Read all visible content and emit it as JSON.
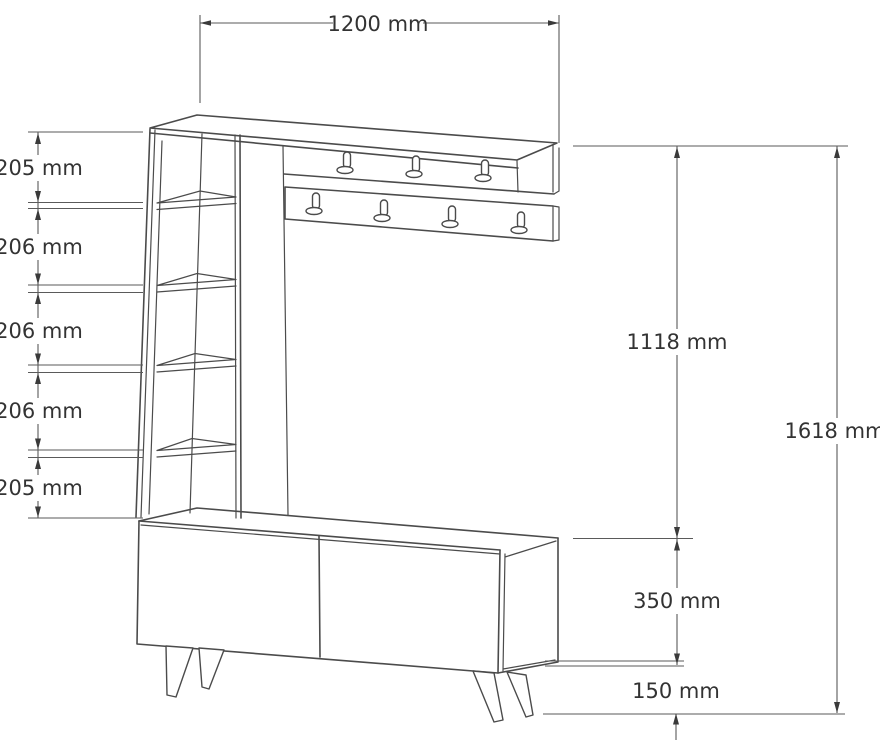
{
  "drawing": {
    "unit": "mm",
    "background_color": "#ffffff",
    "furniture_line_color": "#4b4b4b",
    "dimension_line_color": "#5a5a5a",
    "label_text_color": "#333333"
  },
  "dimensions": {
    "top_width": {
      "label": "1200 mm"
    },
    "left_segments": [
      {
        "label": "205 mm"
      },
      {
        "label": "206 mm"
      },
      {
        "label": "206 mm"
      },
      {
        "label": "206 mm"
      },
      {
        "label": "205 mm"
      }
    ],
    "right": {
      "upper_height": {
        "label": "1118 mm"
      },
      "total_height": {
        "label": "1618 mm"
      },
      "cabinet_height": {
        "label": "350 mm"
      },
      "floor_clearance": {
        "label": "150 mm"
      }
    }
  }
}
